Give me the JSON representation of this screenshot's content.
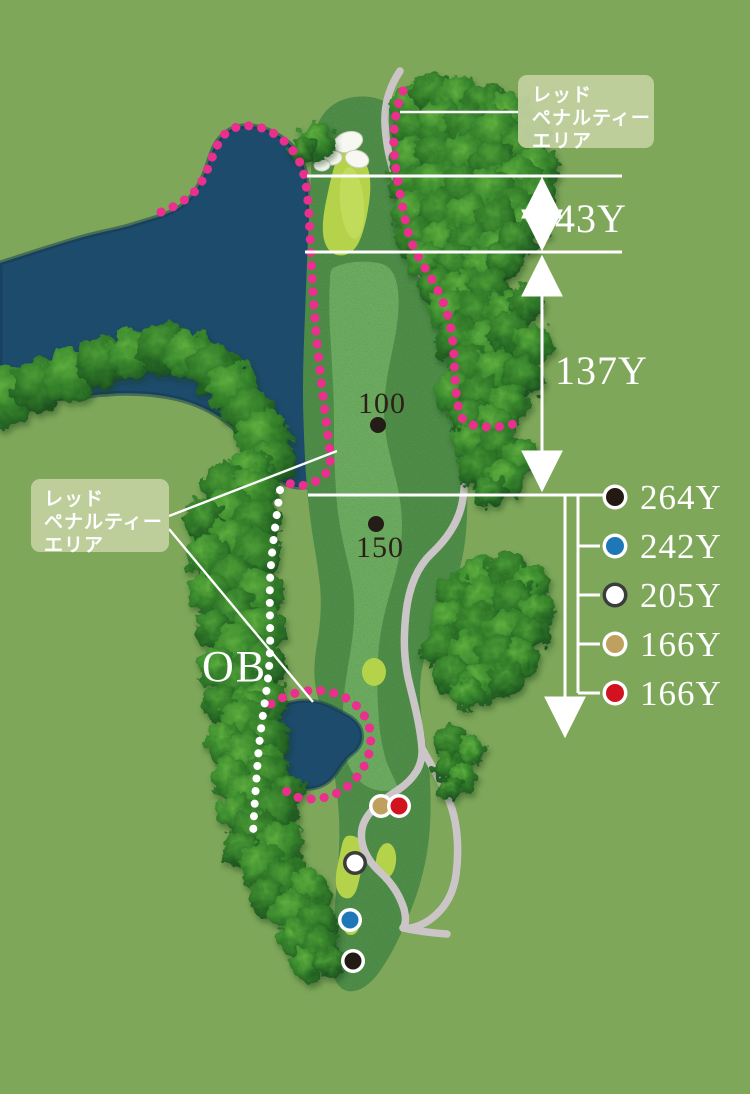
{
  "hole_map": {
    "penalty_area_label": {
      "line1": "レッド",
      "line2": "ペナルティー",
      "line3": "エリア"
    },
    "ob_label": "OB",
    "yardage_markers": {
      "marker_100": "100",
      "marker_150": "150"
    },
    "measurements": {
      "green_depth": "43Y",
      "mid_segment": "137Y"
    },
    "tees": [
      {
        "name": "black-tee",
        "color": "#241a14",
        "ring": "#ffffff",
        "distance": "264Y"
      },
      {
        "name": "blue-tee",
        "color": "#1e78b8",
        "ring": "#ffffff",
        "distance": "242Y"
      },
      {
        "name": "white-tee",
        "color": "#ffffff",
        "ring": "#3c3c3c",
        "distance": "205Y"
      },
      {
        "name": "gold-tee",
        "color": "#c0a05e",
        "ring": "#ffffff",
        "distance": "166Y"
      },
      {
        "name": "red-tee",
        "color": "#d2121e",
        "ring": "#ffffff",
        "distance": "166Y"
      }
    ],
    "colors": {
      "background": "#7ea75a",
      "rough": "#4f8d49",
      "fairway": "#6cab60",
      "green_teebox": "#b5d24b",
      "green_highlight": "#c6dd5f",
      "water": "#1d4b6c",
      "water_edge": "#12374f",
      "cart_path": "#cbc5c7",
      "penalty_line": "#ea2f8e",
      "label_text": "#dc3377",
      "label_box_bg": "#c3d1a0",
      "ob_line": "#ffffff",
      "sand": "#f7f8f2",
      "yardage_dot": "#241c16"
    }
  }
}
